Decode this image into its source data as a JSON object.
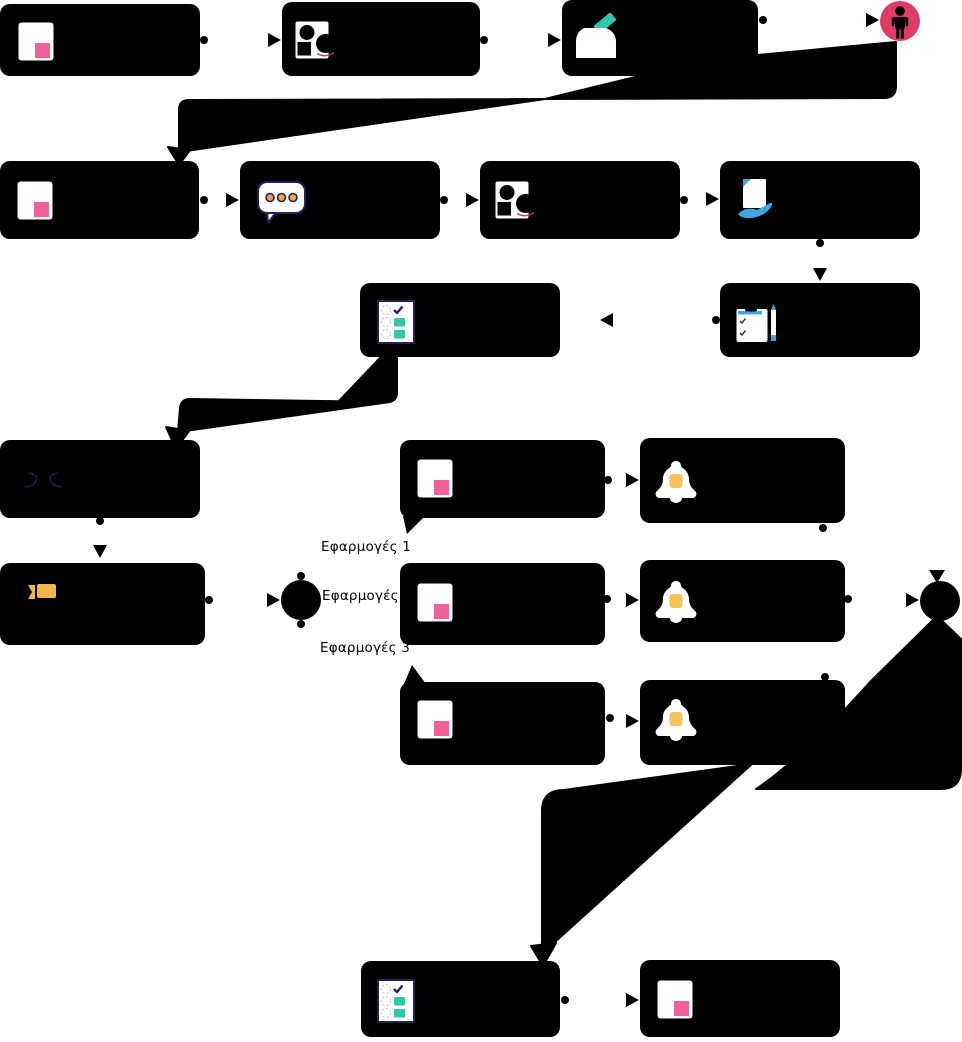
{
  "diagram": {
    "type": "flowchart",
    "background": "#ffffff",
    "node_color": "#000000",
    "accent_colors": {
      "pink": "#f0609b",
      "crimson": "#dd3c66",
      "teal": "#2fc7a7",
      "gold": "#f2b64a",
      "blue": "#3fa8e3",
      "navy": "#23235a"
    },
    "labels": {
      "b1": "Εφαρμογές 1",
      "b2": "Εφαρμογές 2",
      "b3": "Εφαρμογές 3"
    },
    "nodes": [
      {
        "id": "task-document-1",
        "icon": "document-pink-icon"
      },
      {
        "id": "task-profile-1",
        "icon": "profile-shapes-icon"
      },
      {
        "id": "task-submit",
        "icon": "ballot-box-icon"
      },
      {
        "id": "event-person",
        "icon": "person-icon"
      },
      {
        "id": "task-document-2",
        "icon": "document-pink-icon"
      },
      {
        "id": "task-chat",
        "icon": "speech-bubble-icon"
      },
      {
        "id": "task-profile-2",
        "icon": "profile-shapes-icon"
      },
      {
        "id": "task-receive",
        "icon": "hand-document-icon"
      },
      {
        "id": "task-clipboard",
        "icon": "clipboard-pen-icon"
      },
      {
        "id": "task-checklist-1",
        "icon": "checklist-icon"
      },
      {
        "id": "task-code",
        "icon": "code-brackets-icon"
      },
      {
        "id": "task-announce",
        "icon": "megaphone-icon"
      },
      {
        "id": "gateway-split",
        "icon": "filled-circle"
      },
      {
        "id": "task-document-app1",
        "icon": "document-pink-icon"
      },
      {
        "id": "task-notify-app1",
        "icon": "bell-icon"
      },
      {
        "id": "task-document-app2",
        "icon": "document-pink-icon"
      },
      {
        "id": "task-notify-app2",
        "icon": "bell-icon"
      },
      {
        "id": "task-document-app3",
        "icon": "document-pink-icon"
      },
      {
        "id": "task-notify-app3",
        "icon": "bell-icon"
      },
      {
        "id": "gateway-merge",
        "icon": "filled-circle"
      },
      {
        "id": "task-checklist-2",
        "icon": "checklist-icon"
      },
      {
        "id": "task-document-final",
        "icon": "document-pink-icon"
      }
    ]
  }
}
